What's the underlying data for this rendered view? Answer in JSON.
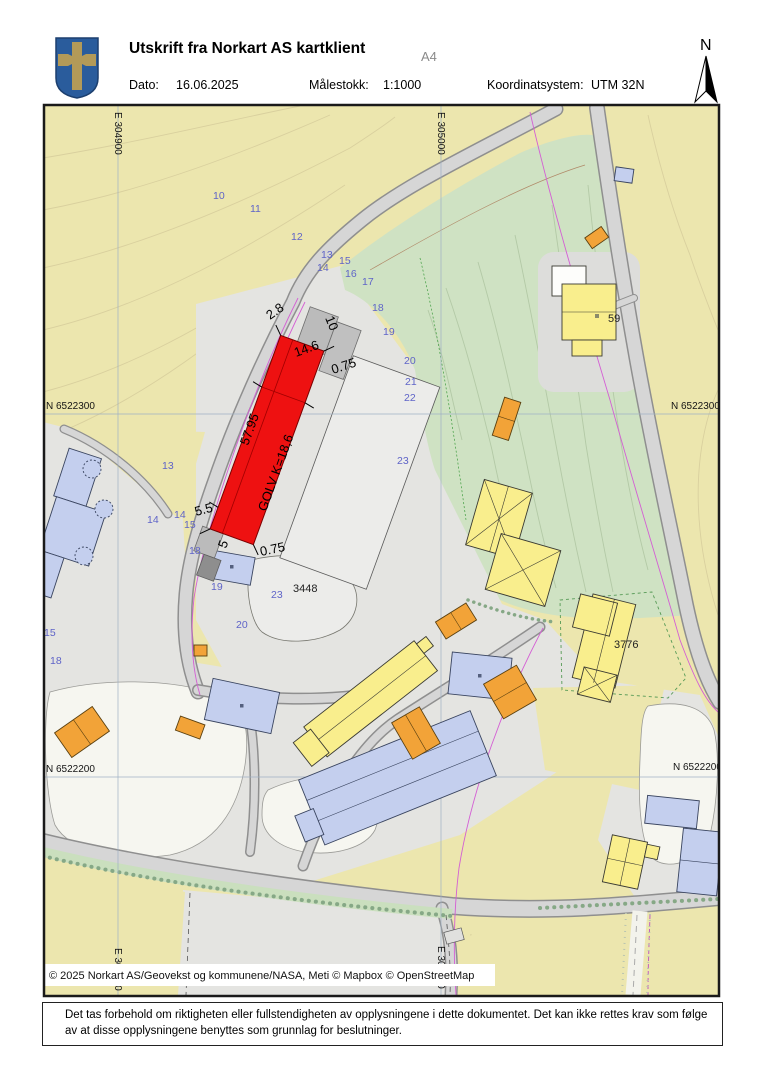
{
  "header": {
    "title": "Utskrift fra Norkart AS kartklient",
    "paper_size": "A4",
    "date_label": "Dato:",
    "date_value": "16.06.2025",
    "scale_label": "Målestokk:",
    "scale_value": "1:1000",
    "coord_label": "Koordinatsystem:",
    "coord_value": "UTM 32N",
    "north_label": "N"
  },
  "map": {
    "grid_labels": [
      {
        "text": "E 304900",
        "x": 115,
        "y": 112,
        "rot": 90
      },
      {
        "text": "E 305000",
        "x": 438,
        "y": 112,
        "rot": 90
      },
      {
        "text": "N 6522300",
        "x": 46,
        "y": 409
      },
      {
        "text": "N 6522300",
        "x": 671,
        "y": 409
      },
      {
        "text": "N 6522200",
        "x": 46,
        "y": 772
      },
      {
        "text": "N 6522200",
        "x": 673,
        "y": 770
      },
      {
        "text": "E 304900",
        "x": 115,
        "y": 948,
        "rot": 90
      },
      {
        "text": "E 305000",
        "x": 438,
        "y": 946,
        "rot": 90
      }
    ],
    "contour_labels": [
      {
        "text": "10",
        "x": 213,
        "y": 199
      },
      {
        "text": "11",
        "x": 250,
        "y": 212
      },
      {
        "text": "12",
        "x": 291,
        "y": 240
      },
      {
        "text": "13",
        "x": 321,
        "y": 258
      },
      {
        "text": "14",
        "x": 317,
        "y": 271
      },
      {
        "text": "15",
        "x": 339,
        "y": 264
      },
      {
        "text": "16",
        "x": 345,
        "y": 277
      },
      {
        "text": "17",
        "x": 362,
        "y": 285
      },
      {
        "text": "18",
        "x": 372,
        "y": 311
      },
      {
        "text": "19",
        "x": 383,
        "y": 335
      },
      {
        "text": "20",
        "x": 404,
        "y": 364
      },
      {
        "text": "21",
        "x": 405,
        "y": 385
      },
      {
        "text": "22",
        "x": 404,
        "y": 401
      },
      {
        "text": "23",
        "x": 397,
        "y": 464
      },
      {
        "text": "13",
        "x": 162,
        "y": 469
      },
      {
        "text": "14",
        "x": 147,
        "y": 523
      },
      {
        "text": "14",
        "x": 174,
        "y": 518
      },
      {
        "text": "15",
        "x": 184,
        "y": 528
      },
      {
        "text": "15",
        "x": 44,
        "y": 636
      },
      {
        "text": "18",
        "x": 50,
        "y": 664
      },
      {
        "text": "18",
        "x": 189,
        "y": 554
      },
      {
        "text": "19",
        "x": 211,
        "y": 590
      },
      {
        "text": "20",
        "x": 236,
        "y": 628
      },
      {
        "text": "23",
        "x": 271,
        "y": 598
      }
    ],
    "dimension_labels": [
      {
        "text": "2.8",
        "x": 270,
        "y": 320,
        "rot": -35
      },
      {
        "text": "10",
        "x": 325,
        "y": 318,
        "rot": 68
      },
      {
        "text": "14.6",
        "x": 296,
        "y": 357,
        "rot": -20
      },
      {
        "text": "0.75",
        "x": 333,
        "y": 374,
        "rot": -18
      },
      {
        "text": "57.95",
        "x": 248,
        "y": 446,
        "rot": -70
      },
      {
        "text": "GOLV K=18,6",
        "x": 266,
        "y": 512,
        "rot": -70
      },
      {
        "text": "5.5",
        "x": 196,
        "y": 516,
        "rot": -15
      },
      {
        "text": "5",
        "x": 226,
        "y": 549,
        "rot": -70
      },
      {
        "text": "0.75",
        "x": 261,
        "y": 556,
        "rot": -12
      }
    ],
    "building_labels": [
      {
        "text": "59",
        "x": 608,
        "y": 322,
        "size": 11
      },
      {
        "text": "3776",
        "x": 614,
        "y": 648,
        "size": 5.5
      },
      {
        "text": "3448",
        "x": 293,
        "y": 592,
        "size": 5.5
      }
    ],
    "copyright": "© 2025 Norkart AS/Geovekst og kommunene/NASA, Meti © Mapbox © OpenStreetMap"
  },
  "footer": {
    "disclaimer": "Det tas forbehold om riktigheten eller fullstendigheten av opplysningene i dette dokumentet. Det kan ikke rettes krav som følge av at disse opplysningene benyttes som grunnlag for beslutninger."
  },
  "colors": {
    "terrain_yellow": "#ece6ae",
    "vegetation_green": "#cfe2c3",
    "road_gray": "#d6d6d6",
    "urban_gray": "#e4e4e1",
    "parking_white": "#f6f6f0",
    "building_yellow": "#f9ee8d",
    "building_blue": "#c4cfee",
    "building_orange": "#f2a338",
    "highlight_red": "#ee1111",
    "contour_label_blue": "#5f64c8",
    "parcel_magenta": "#d45fd4",
    "crest_blue": "#2a5c9c",
    "crest_gold": "#b39a58"
  }
}
